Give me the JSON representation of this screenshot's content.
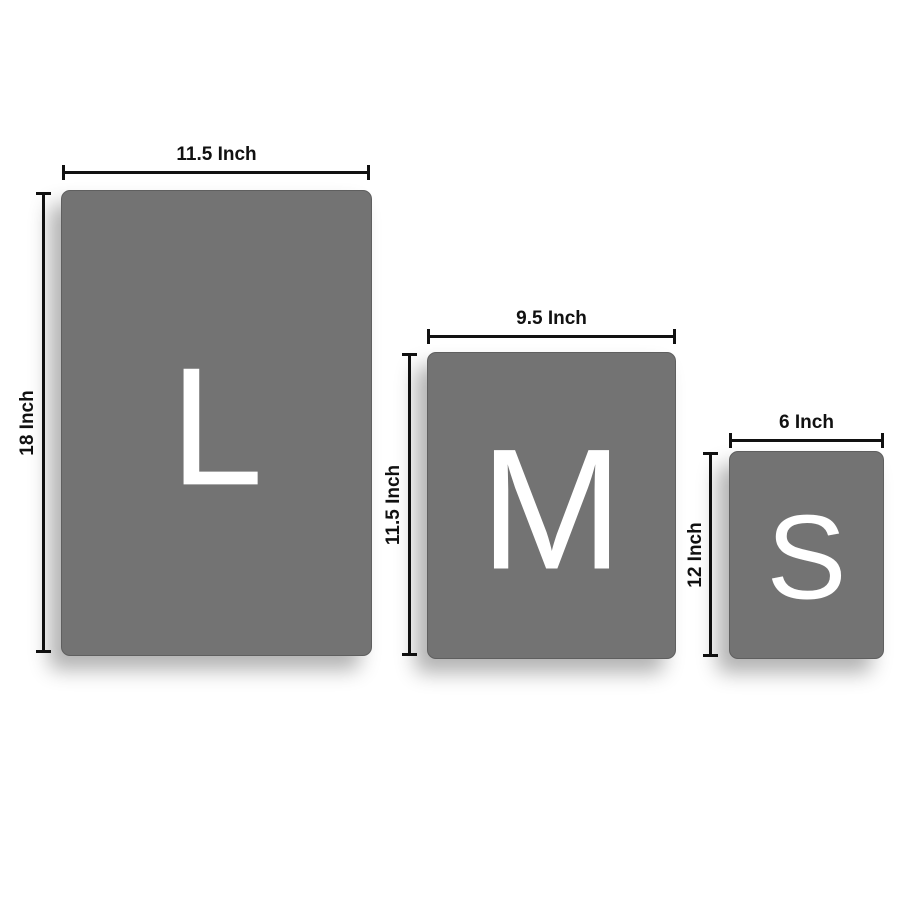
{
  "diagram_title": "Product size comparison",
  "unit": "Inch",
  "colors": {
    "panel": "#737373",
    "line": "#111111",
    "letter": "#ffffff",
    "background": "#ffffff"
  },
  "sizes": [
    {
      "id": "large",
      "letter": "L",
      "width_value": 11.5,
      "height_value": 18,
      "width_label": "11.5 Inch",
      "height_label": "18 Inch"
    },
    {
      "id": "medium",
      "letter": "M",
      "width_value": 9.5,
      "height_value": 11.5,
      "width_label": "9.5 Inch",
      "height_label": "11.5 Inch"
    },
    {
      "id": "small",
      "letter": "S",
      "width_value": 6,
      "height_value": 12,
      "width_label": "6 Inch",
      "height_label": "12 Inch"
    }
  ]
}
